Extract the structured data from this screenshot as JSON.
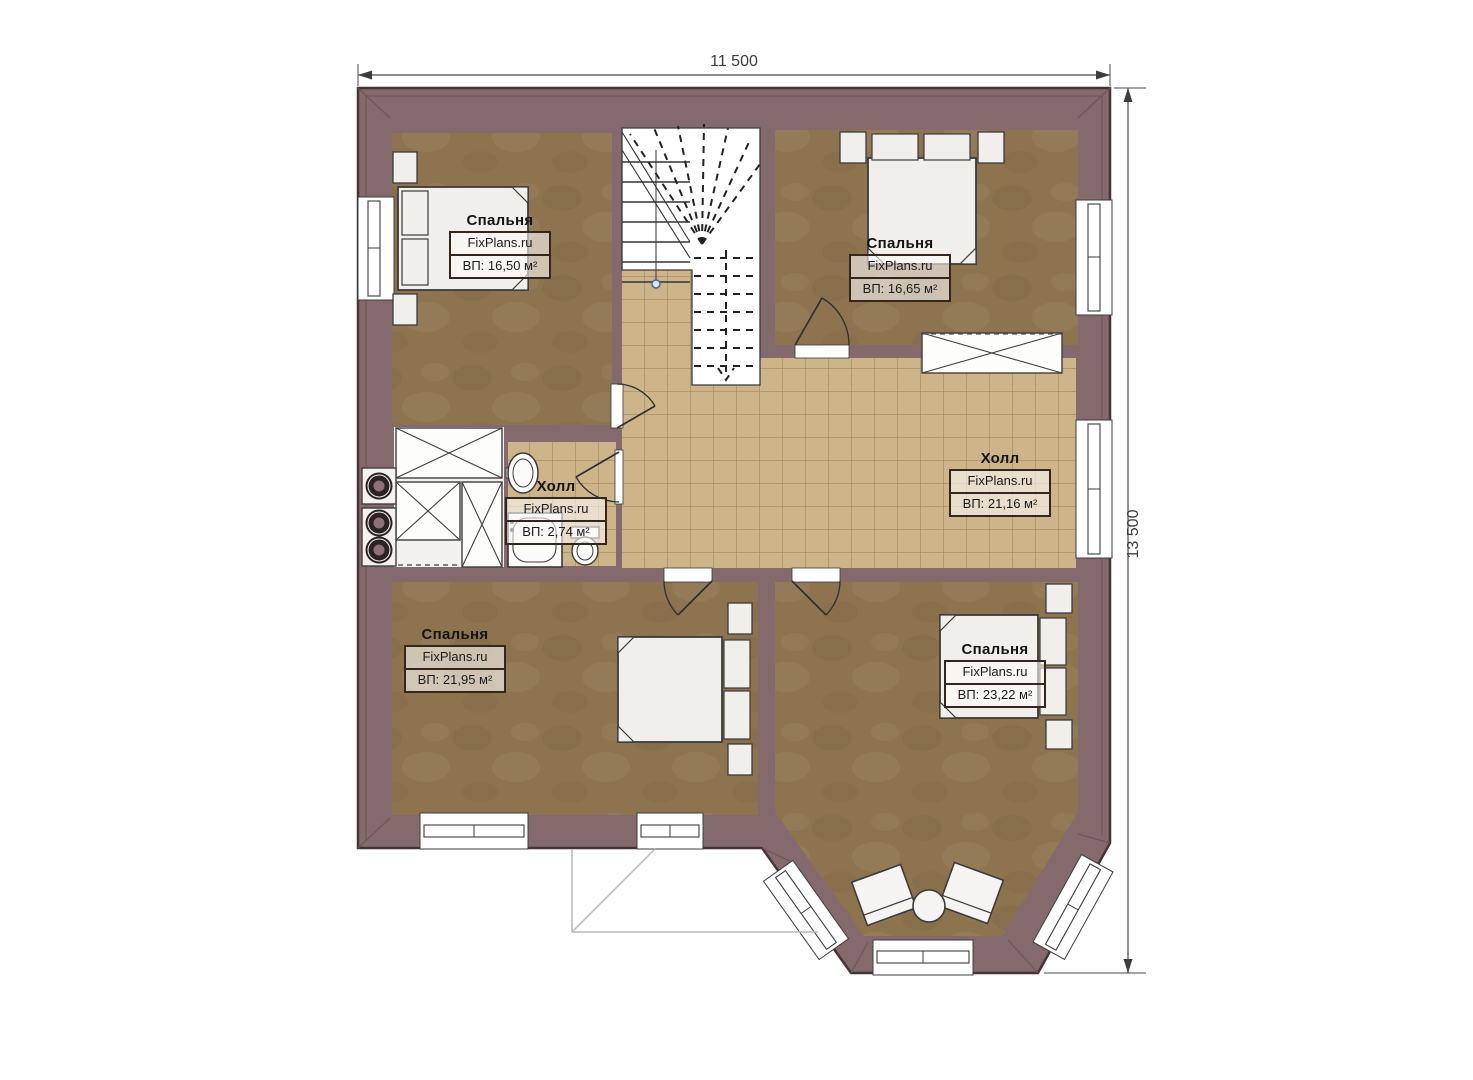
{
  "dimensions": {
    "width": "11 500",
    "height": "13 500"
  },
  "rooms": [
    {
      "id": "bedroom-top-left",
      "name": "Спальня",
      "brand": "FixPlans.ru",
      "area": "ВП: 16,50 м²"
    },
    {
      "id": "bedroom-top-right",
      "name": "Спальня",
      "brand": "FixPlans.ru",
      "area": "ВП: 16,65 м²"
    },
    {
      "id": "hall-small",
      "name": "Холл",
      "brand": "FixPlans.ru",
      "area": "ВП: 2,74 м²"
    },
    {
      "id": "hall-main",
      "name": "Холл",
      "brand": "FixPlans.ru",
      "area": "ВП: 21,16 м²"
    },
    {
      "id": "bedroom-bottom-left",
      "name": "Спальня",
      "brand": "FixPlans.ru",
      "area": "ВП: 21,95 м²"
    },
    {
      "id": "bedroom-bottom-right",
      "name": "Спальня",
      "brand": "FixPlans.ru",
      "area": "ВП: 23,22 м²"
    }
  ],
  "colors": {
    "wall": "#856a6d",
    "bedroom_floor": "#8d744f",
    "tile_floor": "#cdb489",
    "tile_line": "#9d8960"
  }
}
